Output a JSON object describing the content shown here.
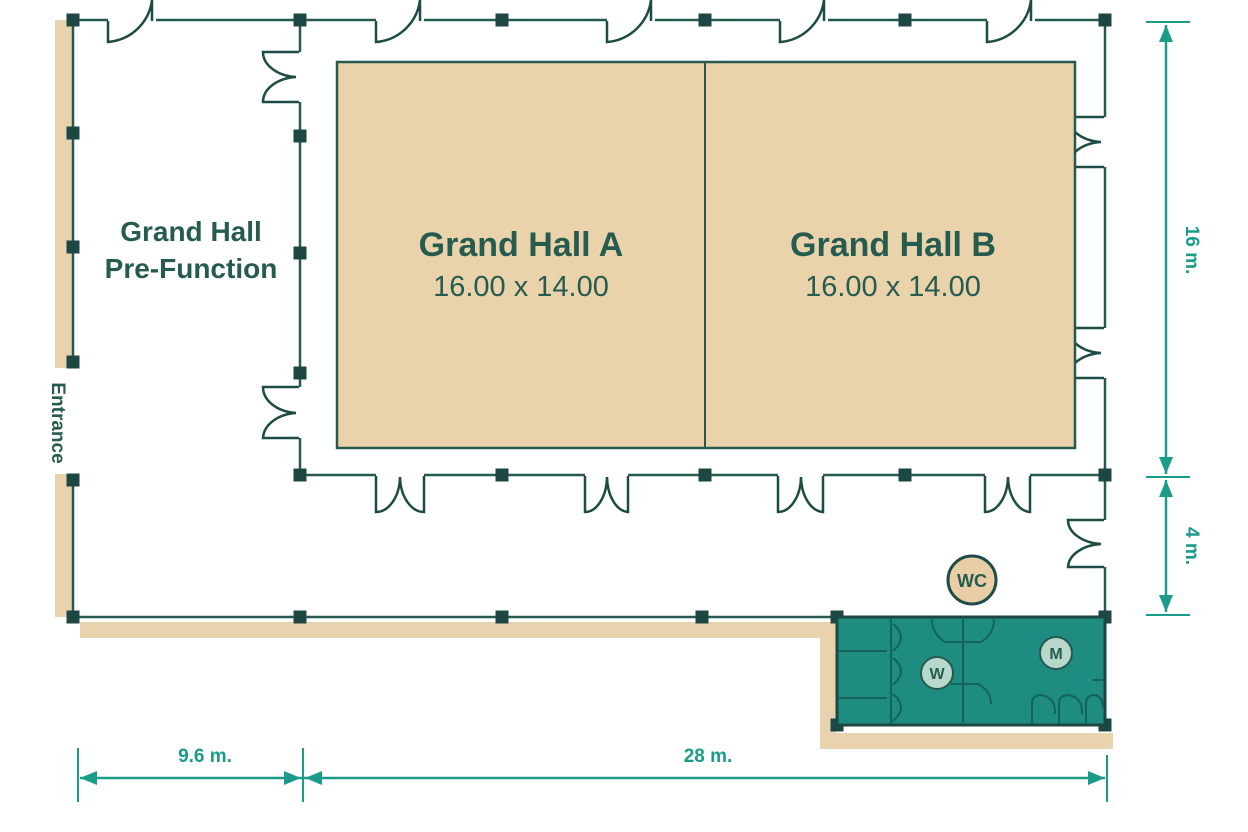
{
  "plan": {
    "title": "Grand Hall floor plan",
    "pre_function": {
      "line1": "Grand Hall",
      "line2": "Pre-Function"
    },
    "hall_a": {
      "name": "Grand Hall A",
      "size": "16.00 x 14.00"
    },
    "hall_b": {
      "name": "Grand Hall B",
      "size": "16.00 x 14.00"
    },
    "entrance_label": "Entrance",
    "restroom": {
      "badge": "WC",
      "women": "W",
      "men": "M"
    },
    "dimensions": {
      "right_upper": "16 m.",
      "right_lower": "4 m.",
      "bottom_left": "9.6 m.",
      "bottom_right": "28 m."
    }
  },
  "colors": {
    "wall": "#265a50",
    "column": "#1d4742",
    "hall_fill": "#ead2ab",
    "walkway_fill": "#e9d3ae",
    "wc_fill": "#1e8c80",
    "wc_interior_line": "#14635b",
    "dimension": "#1b9c8b",
    "label_text": "#265c50",
    "badge_mint": "#b7d8cb",
    "badge_beige": "#e8cda6",
    "background": "#ffffff"
  }
}
